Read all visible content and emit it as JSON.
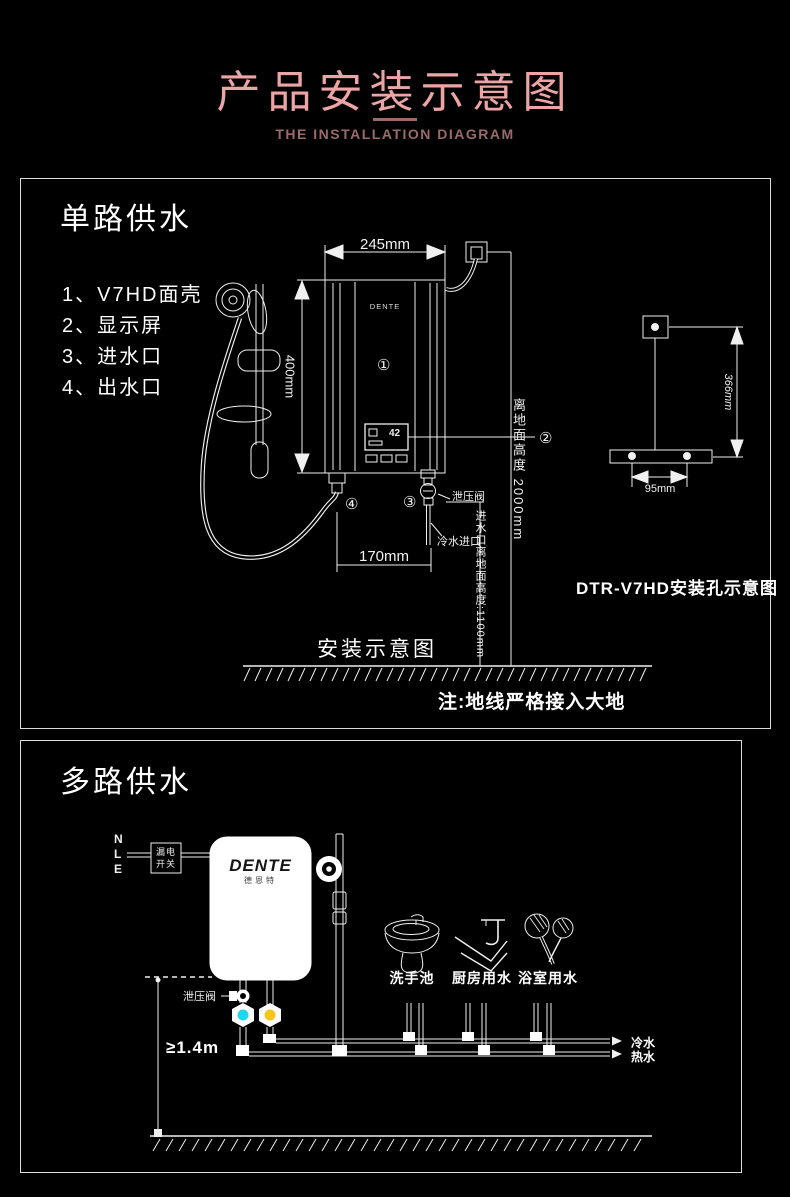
{
  "header": {
    "title": "产品安装示意图",
    "subtitle": "THE INSTALLATION DIAGRAM"
  },
  "colors": {
    "title_pink": "#eda4a4",
    "subtitle_rose": "#9b6a6a",
    "line_art": "#f0f0f0",
    "cold_valve_cyan": "#1fd8ef",
    "hot_valve_yellow": "#f5c518",
    "unit_body": "#ffffff"
  },
  "panel1": {
    "heading": "单路供水",
    "legend": [
      "1、V7HD面壳",
      "2、显示屏",
      "3、进水口",
      "4、出水口"
    ],
    "callouts": [
      "①",
      "②",
      "③",
      "④"
    ],
    "dims": {
      "width": "245mm",
      "height": "400mm",
      "spacing": "170mm",
      "hole_height": "366mm",
      "hole_spacing": "95mm"
    },
    "labels": {
      "wall_height": "离地面高度 2000mm",
      "inlet_height": "进水口离地面高度:1100mm",
      "relief_valve": "泄压阀",
      "cold_inlet": "冷水进口",
      "caption": "安装示意图",
      "hole_caption": "DTR-V7HD安装孔示意图",
      "note": "注:地线严格接入大地",
      "brand": "DENTE",
      "display_value": "42"
    }
  },
  "panel2": {
    "heading": "多路供水",
    "wires": [
      "N",
      "L",
      "E"
    ],
    "breaker": [
      "漏电",
      "开关"
    ],
    "brand": "DENTE",
    "brand_cn": "德恩特",
    "labels": {
      "relief_valve": "泄压阀",
      "min_height": "≥1.4m",
      "cold": "冷水",
      "hot": "热水"
    },
    "fixtures": [
      {
        "label": "洗手池"
      },
      {
        "label": "厨房用水"
      },
      {
        "label": "浴室用水"
      }
    ]
  }
}
